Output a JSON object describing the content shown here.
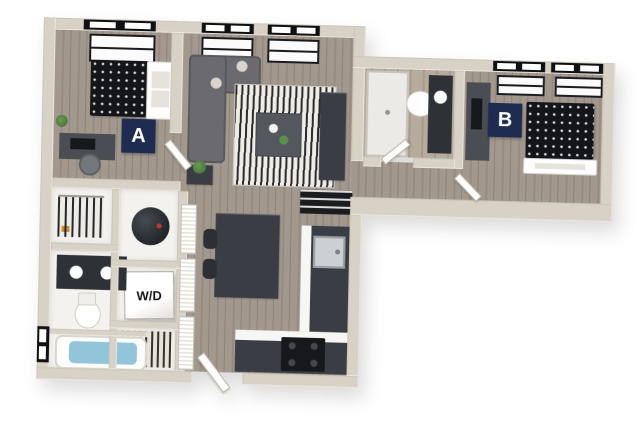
{
  "floorplan": {
    "bedroom_a": {
      "label": "A"
    },
    "bedroom_b": {
      "label": "B"
    },
    "washer_dryer": {
      "label": "W/D"
    }
  },
  "colors": {
    "label-bg": "#1d2c50",
    "label-text": "#ffffff",
    "wall": "#d8d1c5",
    "floor-wood": "#a2988d",
    "floor-wood-dark": "#968c81",
    "bath-floor": "#b7ab9e",
    "counter": "#3a3e44",
    "appliance-black": "#17181c",
    "bed-dark": "#141519",
    "sofa-gray": "#6b6b6f",
    "rug-light": "#efece6",
    "rug-dark": "#2b2b2f",
    "fixture-white": "#fdfdfd",
    "water-blue": "#93c5da",
    "plant-green": "#4c7a3d"
  }
}
